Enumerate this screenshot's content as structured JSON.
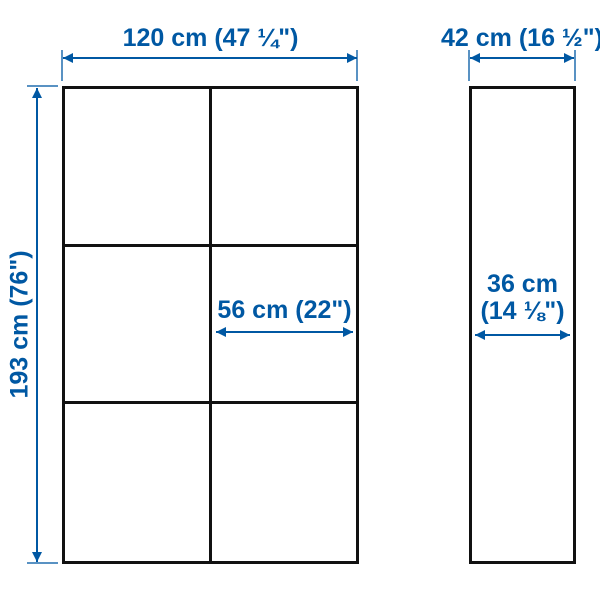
{
  "front_view": {
    "width_label": "120 cm (47 ¼\")",
    "height_label": "193 cm (76\")",
    "shelf_width_label": "56 cm (22\")",
    "columns": 2,
    "rows": 3
  },
  "side_view": {
    "width_label": "42 cm (16 ½\")",
    "depth_label_line1": "36 cm",
    "depth_label_line2": "(14 ⅛\")"
  },
  "colors": {
    "dimension_blue": "#0058a3",
    "outline_black": "#111111",
    "background": "#ffffff"
  }
}
